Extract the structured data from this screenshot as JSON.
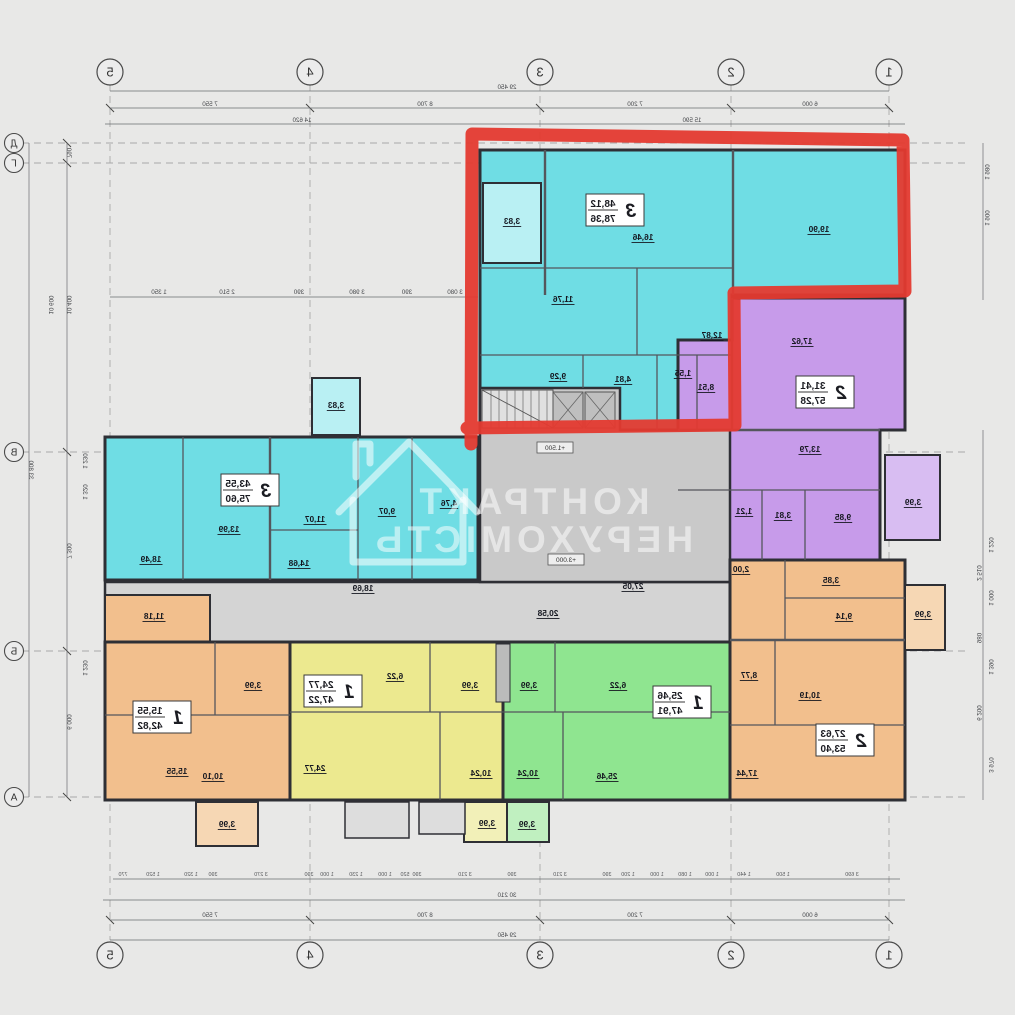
{
  "watermark": {
    "line1": "КОНТРАКТ",
    "line2": "НЕРУХОМІСТЬ"
  },
  "colors": {
    "highlight_red": "#e43a30",
    "cyan": "#6fdde4",
    "purple": "#c79bea",
    "orange": "#f2bf8d",
    "yellow": "#ece98f",
    "green": "#8fe590",
    "core_gray": "#c9c9c9"
  },
  "grid": {
    "columns": [
      {
        "label": "1",
        "x": 126
      },
      {
        "label": "2",
        "x": 284
      },
      {
        "label": "3",
        "x": 475
      },
      {
        "label": "4",
        "x": 705
      },
      {
        "label": "5",
        "x": 905
      }
    ],
    "rows": [
      {
        "label": "Д",
        "y": 143
      },
      {
        "label": "Г",
        "y": 163
      },
      {
        "label": "В",
        "y": 452
      },
      {
        "label": "Б",
        "y": 651
      },
      {
        "label": "А",
        "y": 797
      }
    ]
  },
  "levels": [
    {
      "label": "+1.500",
      "x": 460,
      "y": 450
    },
    {
      "label": "+3.000",
      "x": 449,
      "y": 562
    }
  ],
  "apartments": [
    {
      "number": "3",
      "living_area": "48,12",
      "total_area": "78,36",
      "badge_x": 400,
      "badge_y": 210,
      "rooms": [
        {
          "area": "19,90",
          "x": 196,
          "y": 232
        },
        {
          "area": "16,46",
          "x": 372,
          "y": 240
        },
        {
          "area": "11,76",
          "x": 452,
          "y": 302
        },
        {
          "area": "12,87",
          "x": 303,
          "y": 338
        },
        {
          "area": "9,29",
          "x": 457,
          "y": 379
        },
        {
          "area": "4,81",
          "x": 392,
          "y": 382
        },
        {
          "area": "1,55",
          "x": 332,
          "y": 376
        },
        {
          "area": "3,83",
          "x": 503,
          "y": 224
        }
      ]
    },
    {
      "number": "2",
      "living_area": "31,41",
      "total_area": "57,28",
      "badge_x": 190,
      "badge_y": 392,
      "rooms": [
        {
          "area": "17,62",
          "x": 213,
          "y": 344
        },
        {
          "area": "8,51",
          "x": 309,
          "y": 390
        },
        {
          "area": "13,79",
          "x": 205,
          "y": 452
        },
        {
          "area": "9,85",
          "x": 172,
          "y": 520
        },
        {
          "area": "3,81",
          "x": 232,
          "y": 518
        },
        {
          "area": "1,21",
          "x": 271,
          "y": 514
        },
        {
          "area": "3,99",
          "x": 102,
          "y": 505
        }
      ]
    },
    {
      "number": "3",
      "living_area": "43,55",
      "total_area": "75,60",
      "badge_x": 765,
      "badge_y": 490,
      "rooms": [
        {
          "area": "13,99",
          "x": 786,
          "y": 532
        },
        {
          "area": "11,07",
          "x": 700,
          "y": 522
        },
        {
          "area": "9,07",
          "x": 628,
          "y": 514
        },
        {
          "area": "4,76",
          "x": 566,
          "y": 506
        },
        {
          "area": "14,68",
          "x": 716,
          "y": 566
        },
        {
          "area": "18,49",
          "x": 864,
          "y": 562
        },
        {
          "area": "3,83",
          "x": 679,
          "y": 408
        }
      ]
    },
    {
      "number": "1",
      "living_area": "15,55",
      "total_area": "42,82",
      "badge_x": 853,
      "badge_y": 717,
      "rooms": [
        {
          "area": "15,55",
          "x": 838,
          "y": 774
        },
        {
          "area": "10,10",
          "x": 802,
          "y": 779
        },
        {
          "area": "3,99",
          "x": 762,
          "y": 688
        },
        {
          "area": "3,99",
          "x": 788,
          "y": 827
        }
      ]
    },
    {
      "number": "1",
      "living_area": "24,77",
      "total_area": "47,22",
      "badge_x": 682,
      "badge_y": 691,
      "rooms": [
        {
          "area": "24,77",
          "x": 700,
          "y": 771
        },
        {
          "area": "10,24",
          "x": 534,
          "y": 776
        },
        {
          "area": "6,22",
          "x": 620,
          "y": 679
        },
        {
          "area": "3,99",
          "x": 545,
          "y": 688
        },
        {
          "area": "3,99",
          "x": 528,
          "y": 826
        }
      ]
    },
    {
      "number": "1",
      "living_area": "25,46",
      "total_area": "47,91",
      "badge_x": 333,
      "badge_y": 702,
      "rooms": [
        {
          "area": "25,46",
          "x": 408,
          "y": 779
        },
        {
          "area": "10,24",
          "x": 487,
          "y": 776
        },
        {
          "area": "6,22",
          "x": 397,
          "y": 688
        },
        {
          "area": "3,99",
          "x": 486,
          "y": 688
        },
        {
          "area": "3,99",
          "x": 488,
          "y": 827
        }
      ]
    },
    {
      "number": "2",
      "living_area": "27,63",
      "total_area": "53,40",
      "badge_x": 170,
      "badge_y": 740,
      "rooms": [
        {
          "area": "17,44",
          "x": 268,
          "y": 776
        },
        {
          "area": "10,19",
          "x": 205,
          "y": 698
        },
        {
          "area": "9,14",
          "x": 171,
          "y": 619
        },
        {
          "area": "8,77",
          "x": 266,
          "y": 678
        },
        {
          "area": "3,85",
          "x": 184,
          "y": 583
        },
        {
          "area": "2,00",
          "x": 274,
          "y": 572
        },
        {
          "area": "3,99",
          "x": 92,
          "y": 617
        }
      ]
    }
  ],
  "common_rooms": [
    {
      "area": "27,05",
      "x": 382,
      "y": 589
    },
    {
      "area": "20,58",
      "x": 467,
      "y": 616
    },
    {
      "area": "18,69",
      "x": 652,
      "y": 591
    },
    {
      "area": "11,18",
      "x": 861,
      "y": 619
    }
  ],
  "dimensions": [
    {
      "label": "29 450",
      "x": 508,
      "y": 89
    },
    {
      "label": "6 000",
      "x": 205,
      "y": 106
    },
    {
      "label": "7 200",
      "x": 380,
      "y": 106
    },
    {
      "label": "8 700",
      "x": 590,
      "y": 106
    },
    {
      "label": "7 550",
      "x": 805,
      "y": 106
    },
    {
      "label": "15 590",
      "x": 323,
      "y": 122
    },
    {
      "label": "14 620",
      "x": 713,
      "y": 122
    },
    {
      "label": "3 080",
      "x": 560,
      "y": 294
    },
    {
      "label": "390",
      "x": 608,
      "y": 294
    },
    {
      "label": "3 980",
      "x": 658,
      "y": 294
    },
    {
      "label": "390",
      "x": 716,
      "y": 294
    },
    {
      "label": "2 510",
      "x": 788,
      "y": 294
    },
    {
      "label": "1 350",
      "x": 856,
      "y": 294
    },
    {
      "label": "30 210",
      "x": 508,
      "y": 897
    },
    {
      "label": "6 000",
      "x": 205,
      "y": 917
    },
    {
      "label": "7 200",
      "x": 380,
      "y": 917
    },
    {
      "label": "8 700",
      "x": 590,
      "y": 917
    },
    {
      "label": "7 550",
      "x": 805,
      "y": 917
    },
    {
      "label": "29 450",
      "x": 508,
      "y": 937
    },
    {
      "label": "790",
      "x": 948,
      "y": 153,
      "rot": true
    },
    {
      "label": "10 400",
      "x": 948,
      "y": 305,
      "rot": true
    },
    {
      "label": "10 600",
      "x": 966,
      "y": 305,
      "rot": true
    },
    {
      "label": "1 230",
      "x": 932,
      "y": 461,
      "rot": true
    },
    {
      "label": "1 320",
      "x": 932,
      "y": 492,
      "rot": true
    },
    {
      "label": "7 300",
      "x": 948,
      "y": 551,
      "rot": true
    },
    {
      "label": "1 230",
      "x": 932,
      "y": 668,
      "rot": true
    },
    {
      "label": "6 000",
      "x": 948,
      "y": 722,
      "rot": true
    },
    {
      "label": "33 800",
      "x": 986,
      "y": 470,
      "rot": true
    },
    {
      "label": "1 980",
      "x": 30,
      "y": 172,
      "rot": true
    },
    {
      "label": "1 900",
      "x": 30,
      "y": 218,
      "rot": true
    },
    {
      "label": "1 220",
      "x": 26,
      "y": 545,
      "rot": true
    },
    {
      "label": "2 510",
      "x": 38,
      "y": 573,
      "rot": true
    },
    {
      "label": "1 000",
      "x": 26,
      "y": 598,
      "rot": true
    },
    {
      "label": "980",
      "x": 38,
      "y": 638,
      "rot": true
    },
    {
      "label": "1 390",
      "x": 26,
      "y": 667,
      "rot": true
    },
    {
      "label": "6 200",
      "x": 38,
      "y": 713,
      "rot": true
    },
    {
      "label": "3 970",
      "x": 26,
      "y": 765,
      "rot": true
    }
  ],
  "dimensions_small": [
    {
      "label": "3 690",
      "x": 163
    },
    {
      "label": "1 500",
      "x": 232
    },
    {
      "label": "1 440",
      "x": 271
    },
    {
      "label": "1 000",
      "x": 303
    },
    {
      "label": "1 080",
      "x": 330
    },
    {
      "label": "1 000",
      "x": 358
    },
    {
      "label": "1 200",
      "x": 387
    },
    {
      "label": "390",
      "x": 408
    },
    {
      "label": "3 210",
      "x": 455
    },
    {
      "label": "390",
      "x": 503
    },
    {
      "label": "3 210",
      "x": 550
    },
    {
      "label": "390",
      "x": 598
    },
    {
      "label": "520",
      "x": 610
    },
    {
      "label": "1 000",
      "x": 630
    },
    {
      "label": "1 230",
      "x": 659
    },
    {
      "label": "1 000",
      "x": 688
    },
    {
      "label": "390",
      "x": 706
    },
    {
      "label": "3 270",
      "x": 754
    },
    {
      "label": "390",
      "x": 802
    },
    {
      "label": "1 320",
      "x": 824
    },
    {
      "label": "1 520",
      "x": 862
    },
    {
      "label": "770",
      "x": 892
    }
  ]
}
